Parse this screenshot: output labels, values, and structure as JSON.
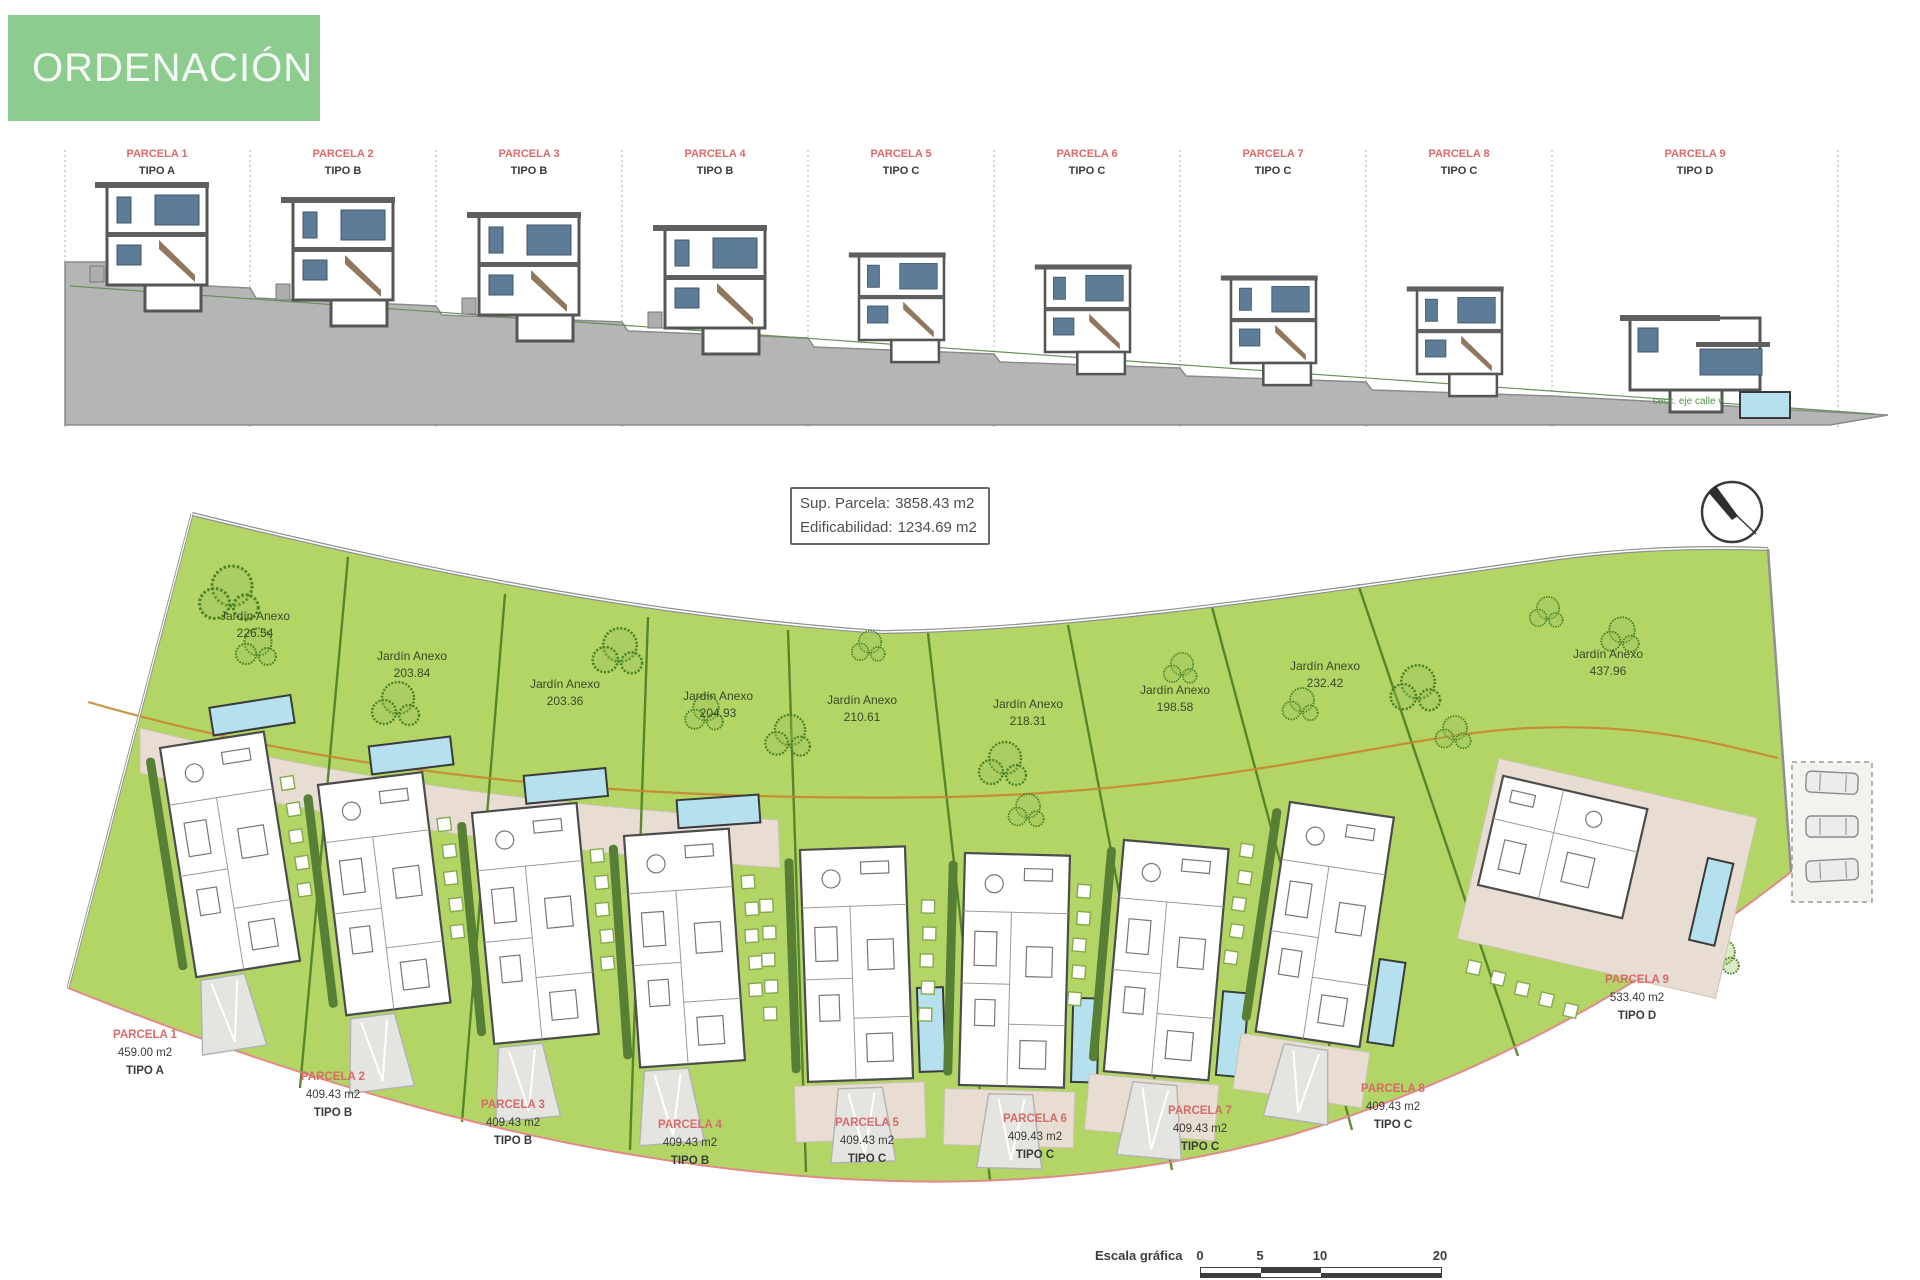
{
  "header": {
    "title": "ORDENACIÓN"
  },
  "elevation": {
    "section_note": "secc. eje calle v",
    "parcels": [
      {
        "name": "PARCELA 1",
        "tipo": "TIPO A"
      },
      {
        "name": "PARCELA 2",
        "tipo": "TIPO B"
      },
      {
        "name": "PARCELA 3",
        "tipo": "TIPO B"
      },
      {
        "name": "PARCELA 4",
        "tipo": "TIPO B"
      },
      {
        "name": "PARCELA 5",
        "tipo": "TIPO C"
      },
      {
        "name": "PARCELA 6",
        "tipo": "TIPO C"
      },
      {
        "name": "PARCELA 7",
        "tipo": "TIPO C"
      },
      {
        "name": "PARCELA 8",
        "tipo": "TIPO C"
      },
      {
        "name": "PARCELA 9",
        "tipo": "TIPO D"
      }
    ]
  },
  "info_box": {
    "rows": [
      {
        "label": "Sup. Parcela:",
        "value": "3858.43 m2"
      },
      {
        "label": "Edificabilidad:",
        "value": "1234.69 m2"
      }
    ]
  },
  "plan": {
    "garden_label": "Jardín Anexo",
    "parcels": [
      {
        "name": "PARCELA 1",
        "area": "459.00 m2",
        "tipo": "TIPO A",
        "garden_area": "226.54"
      },
      {
        "name": "PARCELA 2",
        "area": "409.43 m2",
        "tipo": "TIPO B",
        "garden_area": "203.84"
      },
      {
        "name": "PARCELA 3",
        "area": "409.43 m2",
        "tipo": "TIPO B",
        "garden_area": "203.36"
      },
      {
        "name": "PARCELA 4",
        "area": "409.43 m2",
        "tipo": "TIPO B",
        "garden_area": "204.93"
      },
      {
        "name": "PARCELA 5",
        "area": "409.43 m2",
        "tipo": "TIPO C",
        "garden_area": "210.61"
      },
      {
        "name": "PARCELA 6",
        "area": "409.43 m2",
        "tipo": "TIPO C",
        "garden_area": "218.31"
      },
      {
        "name": "PARCELA 7",
        "area": "409.43 m2",
        "tipo": "TIPO C",
        "garden_area": "198.58"
      },
      {
        "name": "PARCELA 8",
        "area": "409.43 m2",
        "tipo": "TIPO C",
        "garden_area": "232.42"
      },
      {
        "name": "PARCELA 9",
        "area": "533.40 m2",
        "tipo": "TIPO D",
        "garden_area": "437.96"
      }
    ]
  },
  "scale_bar": {
    "label": "Escala gráfica",
    "ticks": [
      "0",
      "5",
      "10",
      "20"
    ]
  },
  "icons": {
    "north_arrow": "north-arrow"
  },
  "colors": {
    "header_green": "#8ECB8E",
    "parcel_red": "#D96A6A",
    "site_green": "#B2D566",
    "terrace_beige": "#E7DDD2",
    "pool_blue": "#B5E0EE",
    "terrain_gray": "#B5B5B5",
    "boundary_red": "#E28A8A",
    "orange_line": "#C8862F",
    "divider_green": "#4E7E22"
  }
}
